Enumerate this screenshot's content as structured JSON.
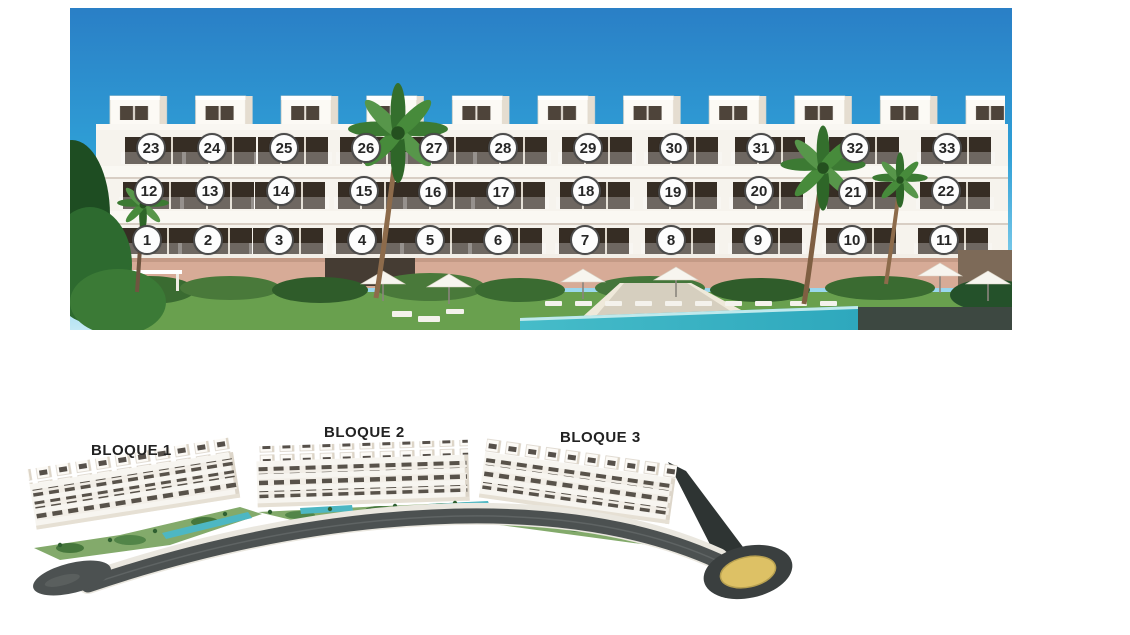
{
  "facade": {
    "description": "front elevation render of apartment building with numbered units",
    "units": [
      {
        "n": 23,
        "x": 151,
        "y": 148
      },
      {
        "n": 24,
        "x": 212,
        "y": 148
      },
      {
        "n": 25,
        "x": 284,
        "y": 148
      },
      {
        "n": 26,
        "x": 366,
        "y": 148
      },
      {
        "n": 27,
        "x": 434,
        "y": 148
      },
      {
        "n": 28,
        "x": 503,
        "y": 148
      },
      {
        "n": 29,
        "x": 588,
        "y": 148
      },
      {
        "n": 30,
        "x": 674,
        "y": 148
      },
      {
        "n": 31,
        "x": 761,
        "y": 148
      },
      {
        "n": 32,
        "x": 855,
        "y": 148
      },
      {
        "n": 33,
        "x": 947,
        "y": 148
      },
      {
        "n": 12,
        "x": 149,
        "y": 191
      },
      {
        "n": 13,
        "x": 210,
        "y": 191
      },
      {
        "n": 14,
        "x": 281,
        "y": 191
      },
      {
        "n": 15,
        "x": 364,
        "y": 191
      },
      {
        "n": 16,
        "x": 433,
        "y": 192
      },
      {
        "n": 17,
        "x": 501,
        "y": 192
      },
      {
        "n": 18,
        "x": 586,
        "y": 191
      },
      {
        "n": 19,
        "x": 673,
        "y": 192
      },
      {
        "n": 20,
        "x": 759,
        "y": 191
      },
      {
        "n": 21,
        "x": 853,
        "y": 192
      },
      {
        "n": 22,
        "x": 946,
        "y": 191
      },
      {
        "n": 1,
        "x": 147,
        "y": 240
      },
      {
        "n": 2,
        "x": 208,
        "y": 240
      },
      {
        "n": 3,
        "x": 279,
        "y": 240
      },
      {
        "n": 4,
        "x": 362,
        "y": 240
      },
      {
        "n": 5,
        "x": 430,
        "y": 240
      },
      {
        "n": 6,
        "x": 498,
        "y": 240
      },
      {
        "n": 7,
        "x": 585,
        "y": 240
      },
      {
        "n": 8,
        "x": 671,
        "y": 240
      },
      {
        "n": 9,
        "x": 758,
        "y": 240
      },
      {
        "n": 10,
        "x": 852,
        "y": 240
      },
      {
        "n": 11,
        "x": 944,
        "y": 240
      }
    ],
    "marker_style": {
      "fill": "#fdfdfd",
      "border": "#4b4b4b",
      "text": "#262626"
    }
  },
  "siteplan": {
    "description": "aerial render of the three residential blocks along a curved road",
    "blocks": [
      {
        "label": "BLOQUE 1",
        "x": 91,
        "y": 442
      },
      {
        "label": "BLOQUE 2",
        "x": 324,
        "y": 424
      },
      {
        "label": "BLOQUE 3",
        "x": 560,
        "y": 429
      }
    ]
  },
  "colors": {
    "sky_top": "#2a7fc6",
    "sky_mid": "#2f9fd6",
    "sky_horizon": "#a8def2",
    "building_white": "#f6f3ed",
    "window_dark": "#362d24",
    "ground_wall_pink": "#d7ab97",
    "grass_green": "#69a04e",
    "pool_teal": "#3db4c4",
    "road_gray": "#4c5151",
    "roundabout_center_gold": "#ddc165",
    "label_text": "#222222"
  }
}
